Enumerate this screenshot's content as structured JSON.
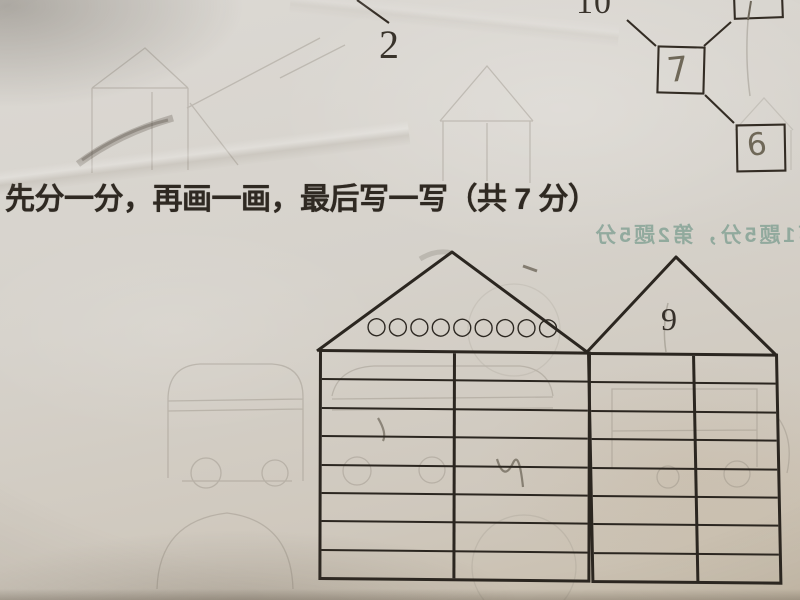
{
  "heading": {
    "text": "先分一分，再画一画，最后写一写（共 7 分）"
  },
  "top_exercise": {
    "printed_2": "2",
    "printed_10": "10",
    "handwritten_box_middle": "7",
    "handwritten_box_bottom": "6"
  },
  "showthrough_note": {
    "mirrored_text": "第1题5分，第2题5分"
  },
  "houses": {
    "left": {
      "roof_circles": "○○○○○○○○○",
      "circles_count": 9,
      "table_rows": 8,
      "table_columns": 2
    },
    "right": {
      "roof_number": "9",
      "table_rows": 8,
      "table_columns": 2
    }
  },
  "colors": {
    "ink": "#2b2620",
    "print_text": "#2f2922",
    "pencil": "#6f6858",
    "paper": "#d4cfc7",
    "showthrough": "#8f897d",
    "mirror_note_teal": "#689282"
  }
}
